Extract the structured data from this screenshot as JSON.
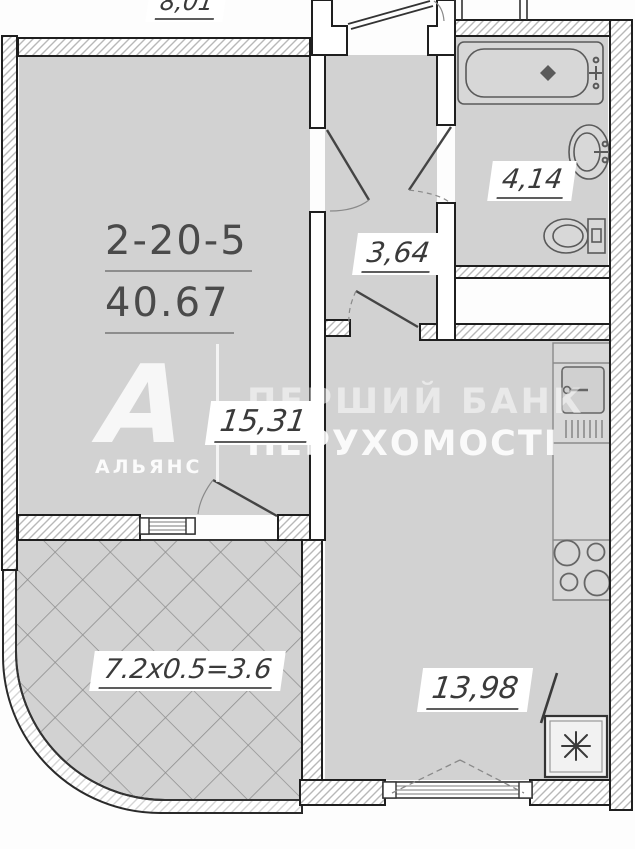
{
  "apartment": {
    "number": "2-20-5",
    "total_area": "40.67"
  },
  "labels": {
    "living_area": "15,31",
    "hall_area": "3,64",
    "bathroom_area": "4,14",
    "kitchen_area": "13,98",
    "balcony_calc": "7.2x0.5=3.6",
    "adjacent_area": "8,01"
  },
  "watermark": {
    "logo_letter": "А",
    "logo_caption": "АЛЬЯНС",
    "line1": "ПЕРШИЙ БАНК",
    "line2": "НЕРУХОМОСТІ"
  },
  "fixtures": [
    "bathtub",
    "washbasin",
    "toilet",
    "kitchen-sink",
    "stove",
    "refrigerator"
  ],
  "colors": {
    "room_fill": "#d2d2d2",
    "wall_outline": "#1f1f1f",
    "hatch_line": "#b8b8b8",
    "diamond_line": "#8f8f8f",
    "label_text": "#3a3a3a",
    "watermark": "#ffffff"
  }
}
